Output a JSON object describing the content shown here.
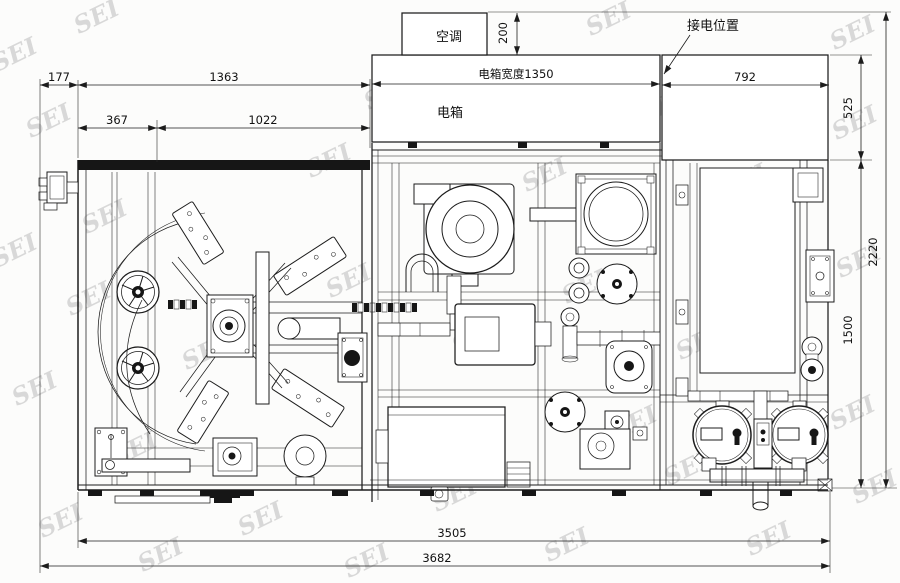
{
  "drawing": {
    "labels": {
      "air_conditioner": "空调",
      "electric_box": "电箱",
      "power_connection": "接电位置"
    },
    "dimensions": {
      "left_offset": "177",
      "left_section_width": "1363",
      "sub_left": "367",
      "sub_right": "1022",
      "electric_box_width": "电箱宽度1350",
      "right_span": "792",
      "ac_depth": "200",
      "top_depth": "525",
      "total_depth": "2220",
      "body_depth": "1500",
      "body_width": "3505",
      "total_width": "3682"
    },
    "watermark": {
      "text": "SEI"
    }
  }
}
